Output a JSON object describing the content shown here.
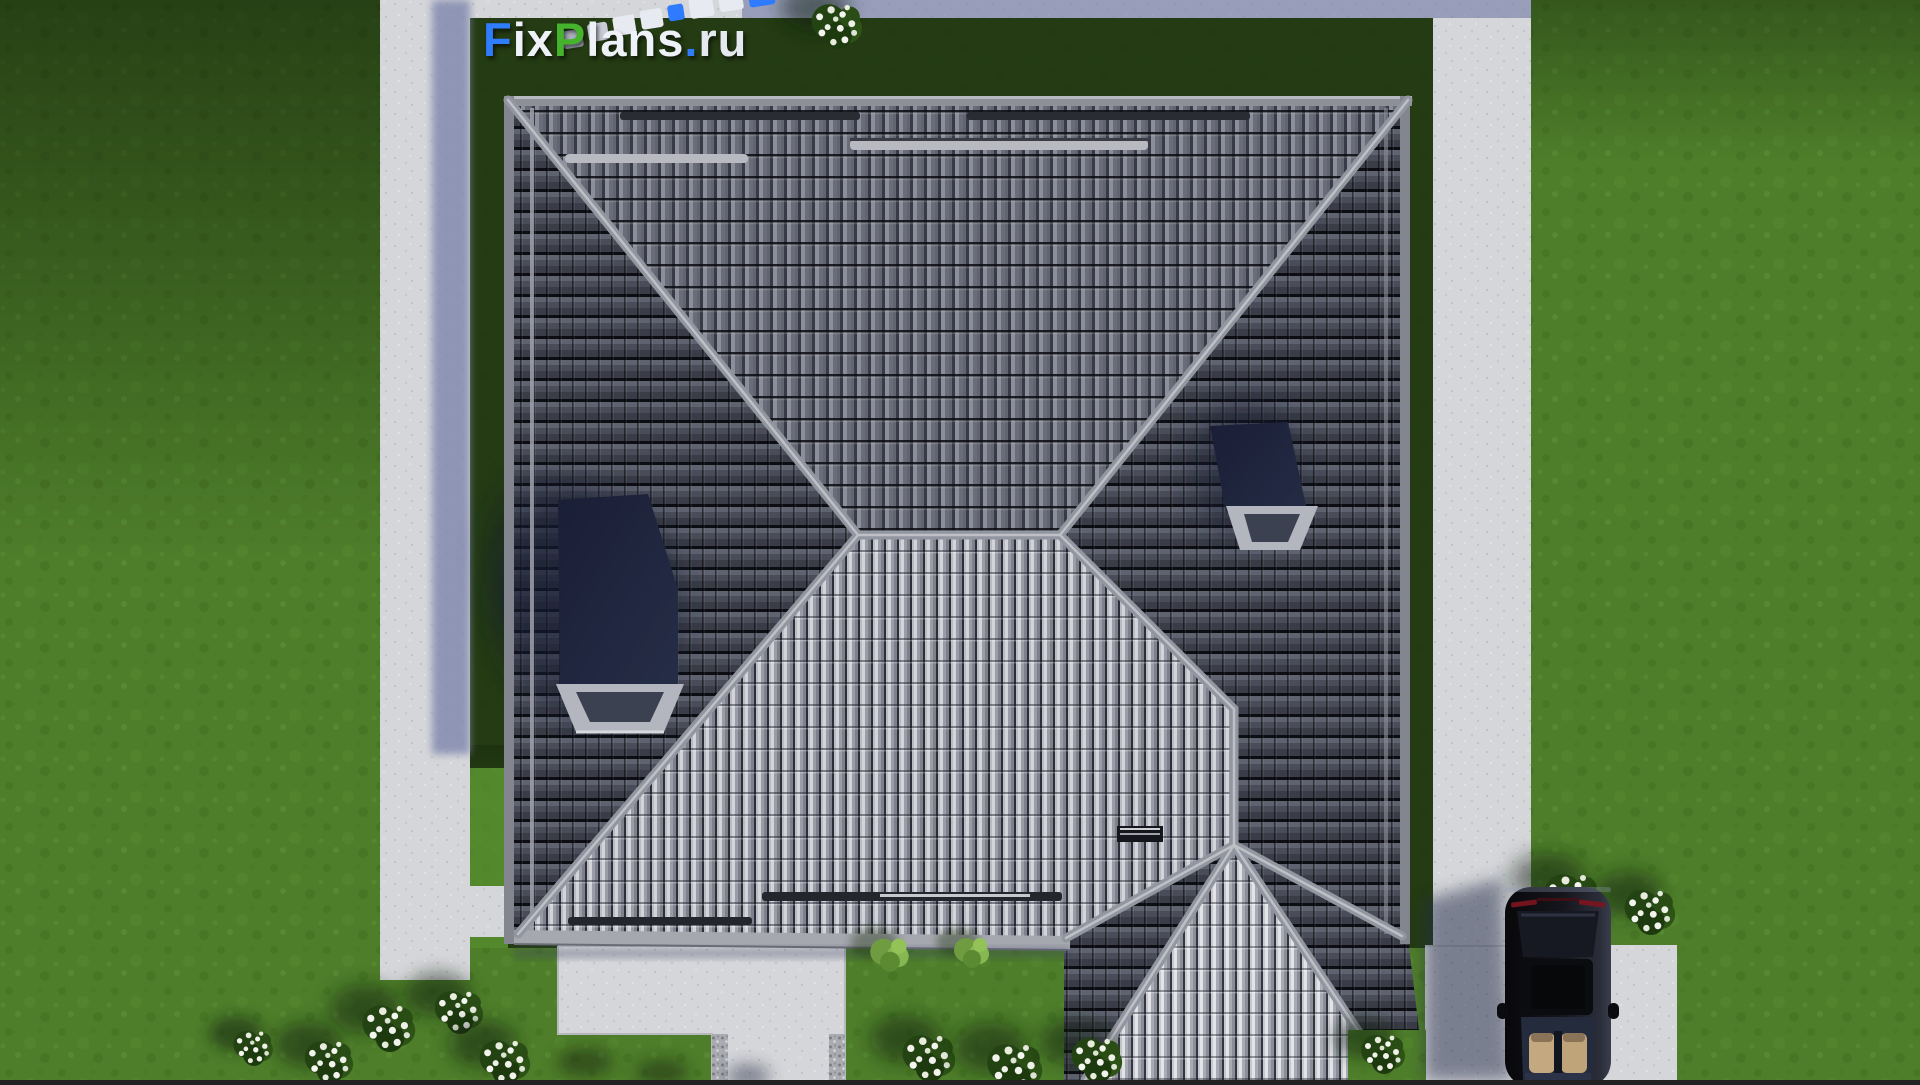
{
  "watermark": {
    "text": "FixPlans.ru",
    "segments": [
      {
        "text": "F",
        "color": "#2f7dfc"
      },
      {
        "text": "ix",
        "color": "#eef1f7"
      },
      {
        "text": "P",
        "color": "#46b32c"
      },
      {
        "text": "lans",
        "color": "#eef1f7"
      },
      {
        "text": ".",
        "color": "#2f7dfc"
      },
      {
        "text": "ru",
        "color": "#e5e8ef"
      }
    ]
  },
  "scene": {
    "type": "aerial-top-view-architectural-render",
    "elements": {
      "roof": "square hip roof with gray tiles and garage extension",
      "skylights": 2,
      "snow_guards": 4,
      "car": "black car parked on driveway, top view",
      "lawn": "green grass with white flowering shrubs",
      "paths": "light concrete walkways, patio and driveway"
    },
    "colors": {
      "grass": "#4e7e2a",
      "lawn_shadow": "#1e3210",
      "concrete": "#d5d6d9",
      "concrete_shadow": "#7e86ad",
      "roof_dark_slope": "#42454f",
      "roof_mid_slope": "#61646f",
      "roof_light_slope": "#94979f",
      "ridge_cap": "#9296a0",
      "skylight_glass": "#2a3148",
      "logo_blue": "#2f7dfc",
      "logo_green": "#46b32c"
    }
  }
}
